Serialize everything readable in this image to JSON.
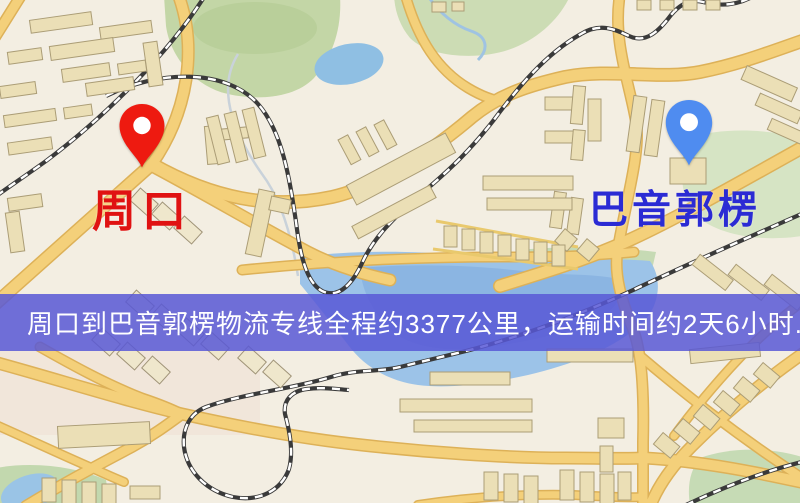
{
  "map": {
    "origin": {
      "name": "周口",
      "label_color": "#e01212",
      "pin_color": "#ee1a10"
    },
    "destination": {
      "name": "巴音郭楞",
      "label_color": "#2b2bd4",
      "pin_color": "#4f8cf0"
    },
    "banner": {
      "text": "周口到巴音郭楞物流专线全程约3377公里，运输时间约2天6小时.",
      "bg_color": "rgba(88,88,214,0.85)",
      "text_color": "#ffffff"
    },
    "route": {
      "distance_km": "3377",
      "duration": "2天6小时"
    }
  }
}
